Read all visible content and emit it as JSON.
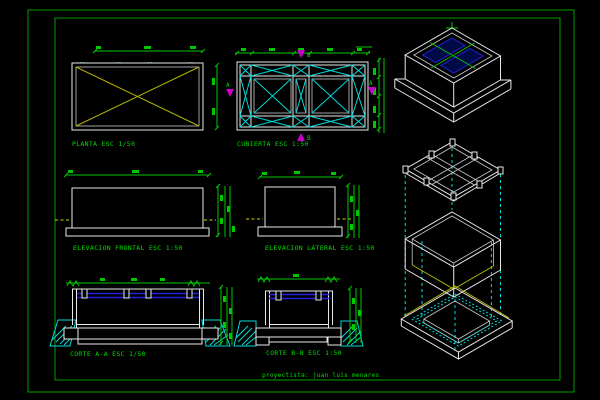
{
  "sheet": {
    "background": "#000000",
    "border_color": "#00a000",
    "credit": "proyectista: juan luis menares"
  },
  "colors": {
    "green_dim": "#00c800",
    "green_text": "#00dc00",
    "white_lines": "#e9e9e9",
    "cyan": "#00d9d9",
    "yellow": "#b4b400",
    "blue_water": "#2121dd",
    "magenta_marker": "#cc00cc"
  },
  "views": {
    "planta": {
      "label": "PLANTA ESC 1/50"
    },
    "cubierta": {
      "label": "CUBIERTA ESC 1:50"
    },
    "elevacion_frontal": {
      "label": "ELEVACION FRONTAL ESC 1:50"
    },
    "elevacion_lateral": {
      "label": "ELEVACION LATERAL ESC 1:50"
    },
    "corte_aa": {
      "label": "CORTE A-A ESC 1/50"
    },
    "corte_bb": {
      "label": "CORTE B-B ESC 1:50"
    }
  },
  "section_markers": {
    "a": "A",
    "b": "B"
  }
}
